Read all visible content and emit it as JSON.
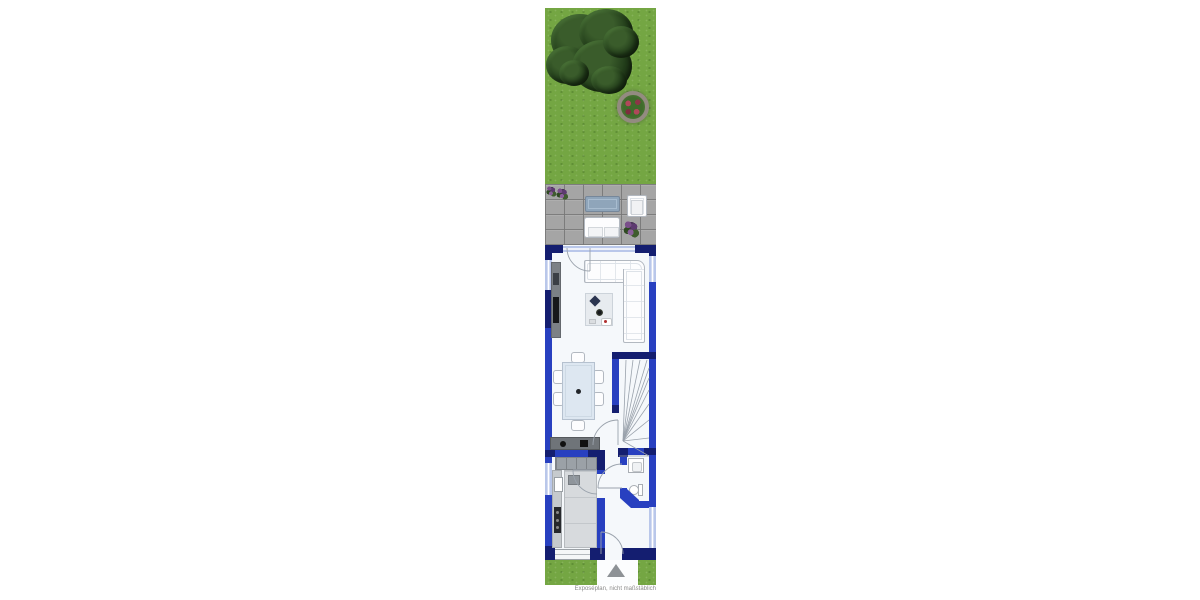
{
  "caption": "Exposéplan, nicht maßstäblich",
  "colors": {
    "wall": "#2840c0",
    "wall_dark": "#141e70",
    "window_blue": "#b9c7ea",
    "grass": "#74a643",
    "paver": "#a5a5a5",
    "floor": "#f5f8fb",
    "furniture_outline": "#b2b8c0",
    "counter_gray": "#9ba1a7",
    "sideboard_gray": "#7c8186",
    "dining_table_blue": "#dde7f1",
    "entrance_arrow": "#8e9296",
    "caption_text": "#8a8a8a"
  },
  "icons": {
    "entrance_marker": "triangle-up"
  }
}
